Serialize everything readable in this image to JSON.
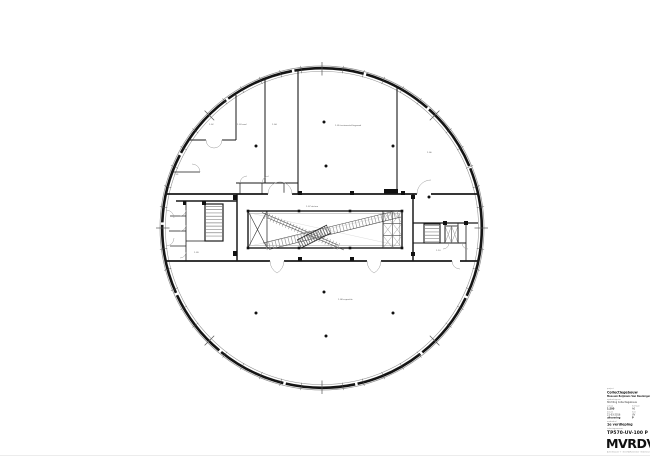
{
  "plan": {
    "labels": [
      {
        "text": "1.02"
      },
      {
        "text": "1.03 zaal"
      },
      {
        "text": "1.04"
      },
      {
        "text": "1.05 tentoonstellingszaal"
      },
      {
        "text": "1.06"
      },
      {
        "text": "1.01"
      },
      {
        "text": "1.07 atrium"
      },
      {
        "text": "1.08 expositie"
      },
      {
        "text": "1.09"
      },
      {
        "text": "1.10"
      }
    ]
  },
  "title_block": {
    "project_label": "project",
    "project_name": "Collectiegebouw",
    "project_location": "Museum Boijmans Van Beuningen, Rotterdam",
    "client_label": "opdrachtgever",
    "client": "Stichting Collectiegebouw",
    "scale_label": "schaal",
    "scale": "1:200",
    "format_label": "formaat",
    "format": "A0",
    "date_label": "datum",
    "date": "21-03-2016",
    "phase_label": "fase",
    "phase": "UV",
    "status": "uitvoering",
    "revision": "P",
    "part_label": "onderdeel",
    "part": "1e verdieping",
    "number_label": "tekeningnummer",
    "number": "TP570-UV-100 P",
    "logo": "MVRDV",
    "address": "Achterklooster 7 · 3011 RA Rotterdam · Nederland"
  }
}
